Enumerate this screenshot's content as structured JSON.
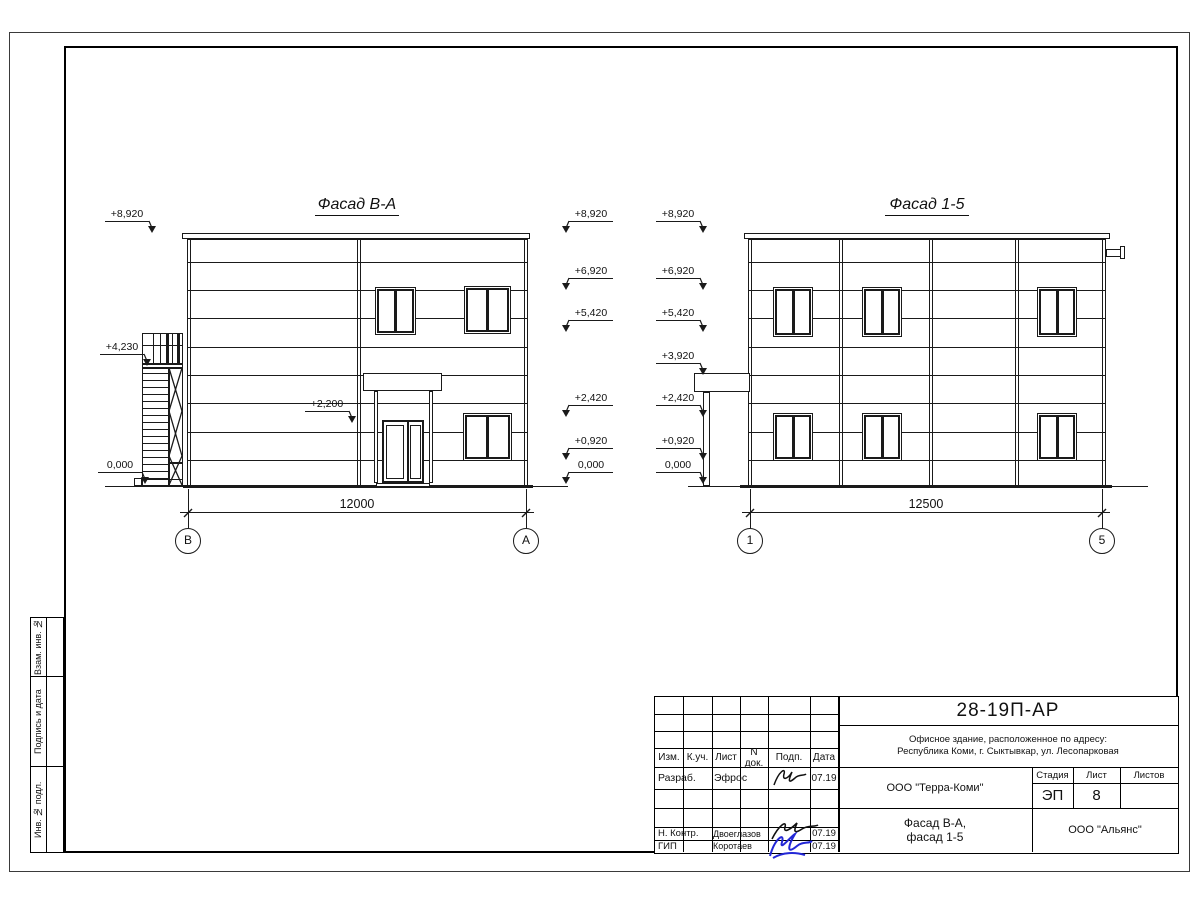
{
  "sheet": {
    "facade_left": {
      "title": "Фасад В-А",
      "dimension": "12000",
      "axis_left": "В",
      "axis_right": "А",
      "elevations_left": [
        "+8,920",
        "+4,230",
        "0,000"
      ],
      "elevation_inner": "+2,200",
      "elevations_right": [
        "+8,920",
        "+6,920",
        "+5,420",
        "+2,420",
        "+0,920",
        "0,000"
      ]
    },
    "facade_right": {
      "title": "Фасад 1-5",
      "dimension": "12500",
      "axis_left": "1",
      "axis_right": "5",
      "elevations_left": [
        "+8,920",
        "+6,920",
        "+5,420",
        "+3,920",
        "+2,420",
        "+0,920",
        "0,000"
      ]
    }
  },
  "title_block": {
    "doc_number": "28-19П-АР",
    "address_line1": "Офисное здание, расположенное по адресу:",
    "address_line2": "Республика Коми, г. Сыктывкар, ул. Лесопарковая",
    "company": "ООО \"Терра-Коми\"",
    "stage_label": "Стадия",
    "sheet_label": "Лист",
    "sheets_label": "Листов",
    "stage": "ЭП",
    "sheet_number": "8",
    "sheets_total": "",
    "drawing_title_line1": "Фасад В-А,",
    "drawing_title_line2": "фасад 1-5",
    "contractor": "ООО \"Альянс\"",
    "header_cells": [
      "Изм.",
      "К.уч.",
      "Лист",
      "N док.",
      "Подп.",
      "Дата"
    ],
    "rows": [
      {
        "role": "Разраб.",
        "name": "Эфрос",
        "date": "07.19"
      },
      {
        "role": "Н. Контр.",
        "name": "Двоеглазов",
        "date": "07.19"
      },
      {
        "role": "ГИП",
        "name": "Коротаев",
        "date": "07.19"
      }
    ]
  },
  "side_strip": {
    "labels": [
      "Взам. инв. №",
      "Подпись и дата",
      "Инв. № подл."
    ]
  }
}
